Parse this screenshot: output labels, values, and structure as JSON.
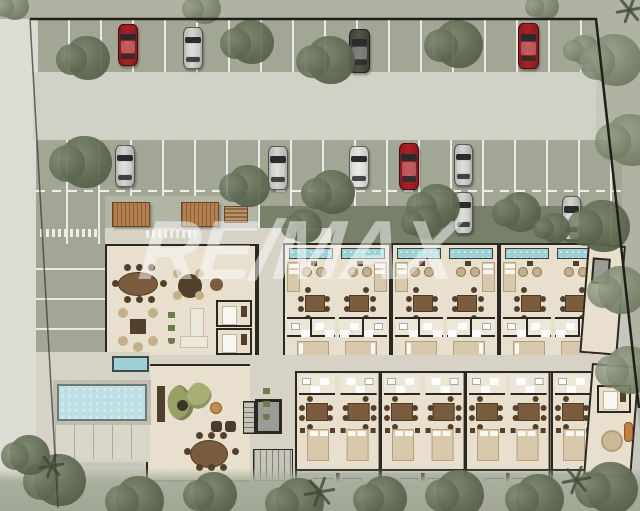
{
  "watermark": {
    "text": "RE/MAX",
    "opacity": 0.5
  },
  "colors": {
    "bg": "#cac9bf",
    "street": "#e0dfd7",
    "outside": "#b2b4a4",
    "cobble": "#a4a896",
    "driveway": "#d3d4c9",
    "hedge": "#79816b",
    "deck": "#d8d5c9",
    "floor": "#ebe2d0",
    "wall": "#2b2620",
    "pool": "#bfe2e6",
    "unit_pool": "#9fd2d9",
    "bath": "#f0eadd",
    "wood": "#7b5c3d",
    "wood_dark": "#52402c",
    "rattan": "#c7b18d",
    "pergola": "#b5824f",
    "sofa_green": "#99a266",
    "elevator": "#9c9d98",
    "stair": "#c9c7bb",
    "veg": "#5c6750",
    "veg2": "#77816a",
    "car_red": "#ab2025",
    "car_silver": "#d7d8d3",
    "car_white": "#e6e7e3",
    "car_dark": "#54544d",
    "car_win": "#272c2e"
  },
  "cars": [
    {
      "x": 118,
      "y": 24,
      "w": 20,
      "h": 42,
      "color": "red"
    },
    {
      "x": 183,
      "y": 27,
      "w": 20,
      "h": 42,
      "color": "silver"
    },
    {
      "x": 349,
      "y": 29,
      "w": 21,
      "h": 44,
      "color": "dark"
    },
    {
      "x": 518,
      "y": 23,
      "w": 21,
      "h": 46,
      "color": "red"
    },
    {
      "x": 115,
      "y": 145,
      "w": 20,
      "h": 42,
      "color": "silver"
    },
    {
      "x": 268,
      "y": 146,
      "w": 20,
      "h": 44,
      "color": "silver"
    },
    {
      "x": 349,
      "y": 146,
      "w": 20,
      "h": 42,
      "color": "white"
    },
    {
      "x": 399,
      "y": 143,
      "w": 20,
      "h": 47,
      "color": "red"
    },
    {
      "x": 454,
      "y": 144,
      "w": 19,
      "h": 42,
      "color": "silver"
    },
    {
      "x": 454,
      "y": 192,
      "w": 19,
      "h": 42,
      "color": "silver"
    },
    {
      "x": 562,
      "y": 196,
      "w": 19,
      "h": 44,
      "color": "silver"
    }
  ],
  "trees": [
    {
      "x": 88,
      "y": 58,
      "r": 22,
      "tone": "d"
    },
    {
      "x": 252,
      "y": 42,
      "r": 22,
      "tone": "d"
    },
    {
      "x": 331,
      "y": 60,
      "r": 24,
      "tone": "d"
    },
    {
      "x": 459,
      "y": 44,
      "r": 24,
      "tone": "d"
    },
    {
      "x": 585,
      "y": 50,
      "r": 15,
      "tone": "m"
    },
    {
      "x": 205,
      "y": 8,
      "r": 16,
      "tone": "m"
    },
    {
      "x": 545,
      "y": 6,
      "r": 14,
      "tone": "m"
    },
    {
      "x": 15,
      "y": 6,
      "r": 14,
      "tone": "m"
    },
    {
      "x": 86,
      "y": 162,
      "r": 26,
      "tone": "d"
    },
    {
      "x": 249,
      "y": 186,
      "r": 21,
      "tone": "d"
    },
    {
      "x": 333,
      "y": 192,
      "r": 22,
      "tone": "d"
    },
    {
      "x": 438,
      "y": 206,
      "r": 22,
      "tone": "d"
    },
    {
      "x": 521,
      "y": 212,
      "r": 20,
      "tone": "d"
    },
    {
      "x": 604,
      "y": 226,
      "r": 26,
      "tone": "d"
    },
    {
      "x": 305,
      "y": 226,
      "r": 17,
      "tone": "d"
    },
    {
      "x": 425,
      "y": 222,
      "r": 17,
      "tone": "d"
    },
    {
      "x": 555,
      "y": 228,
      "r": 15,
      "tone": "d"
    },
    {
      "x": 616,
      "y": 60,
      "r": 26,
      "tone": "m"
    },
    {
      "x": 632,
      "y": 140,
      "r": 26,
      "tone": "m"
    },
    {
      "x": 622,
      "y": 290,
      "r": 24,
      "tone": "m"
    },
    {
      "x": 630,
      "y": 370,
      "r": 24,
      "tone": "m"
    },
    {
      "x": 60,
      "y": 480,
      "r": 26,
      "tone": "d"
    },
    {
      "x": 140,
      "y": 500,
      "r": 24,
      "tone": "d"
    },
    {
      "x": 215,
      "y": 494,
      "r": 22,
      "tone": "d"
    },
    {
      "x": 300,
      "y": 502,
      "r": 24,
      "tone": "d"
    },
    {
      "x": 385,
      "y": 498,
      "r": 22,
      "tone": "d"
    },
    {
      "x": 460,
      "y": 494,
      "r": 24,
      "tone": "d"
    },
    {
      "x": 540,
      "y": 498,
      "r": 24,
      "tone": "d"
    },
    {
      "x": 612,
      "y": 488,
      "r": 26,
      "tone": "d"
    },
    {
      "x": 30,
      "y": 455,
      "r": 20,
      "tone": "d"
    }
  ],
  "palms": [
    {
      "x": 318,
      "y": 492,
      "s": 16
    },
    {
      "x": 575,
      "y": 480,
      "s": 15
    },
    {
      "x": 50,
      "y": 466,
      "s": 13
    },
    {
      "x": 628,
      "y": 10,
      "s": 14
    }
  ],
  "units": {
    "top_row": {
      "count": 6,
      "x": 283,
      "y": 243,
      "w": 54,
      "h": 114
    },
    "bottom_row": {
      "count": 7,
      "x": 293,
      "y": 371,
      "w": 42.6,
      "h": 100
    },
    "top_features": [
      "plunge-pool",
      "terrace-chairs",
      "bed",
      "dining-table",
      "bathroom",
      "second-bed"
    ],
    "bottom_features": [
      "bathroom",
      "dining-table",
      "bed",
      "terrace-plunge-pool"
    ]
  },
  "furniture": [
    {
      "t": "pergola",
      "n": "pergola-deck",
      "x": 112,
      "y": 202,
      "w": 38,
      "h": 25
    },
    {
      "t": "pergola",
      "n": "pergola-deck",
      "x": 181,
      "y": 202,
      "w": 38,
      "h": 25
    },
    {
      "t": "bike-rack",
      "n": "bike-rack",
      "x": 224,
      "y": 206,
      "w": 24,
      "h": 17
    },
    {
      "t": "grate",
      "n": "drain-grate",
      "x": 40,
      "y": 229,
      "w": 60,
      "h": 8
    },
    {
      "t": "grate",
      "n": "drain-grate",
      "x": 146,
      "y": 230,
      "w": 50,
      "h": 8
    },
    {
      "t": "oval-table",
      "n": "lobby-dining-table",
      "x": 118,
      "y": 272,
      "w": 40,
      "h": 24
    },
    {
      "t": "round-table",
      "n": "lobby-round-table",
      "x": 178,
      "y": 274,
      "w": 24,
      "h": 24
    },
    {
      "t": "side-table",
      "n": "lobby-side-table",
      "x": 210,
      "y": 278,
      "w": 13,
      "h": 13
    },
    {
      "t": "lounge-set",
      "n": "lobby-lounge-set",
      "x": 116,
      "y": 306,
      "w": 44,
      "h": 42
    },
    {
      "t": "desk-sofa",
      "n": "reception-sofa",
      "x": 178,
      "y": 308,
      "w": 28,
      "h": 38
    },
    {
      "t": "plant-row",
      "n": "planter-row",
      "x": 168,
      "y": 306,
      "w": 7,
      "h": 38
    },
    {
      "t": "room-bed",
      "n": "treatment-room",
      "x": 216,
      "y": 300,
      "w": 36,
      "h": 27
    },
    {
      "t": "room-bed",
      "n": "treatment-room",
      "x": 216,
      "y": 328,
      "w": 36,
      "h": 27
    },
    {
      "t": "console",
      "n": "console",
      "x": 157,
      "y": 386,
      "w": 8,
      "h": 36
    },
    {
      "t": "curved-sofa",
      "n": "curved-sofa",
      "x": 167,
      "y": 383,
      "w": 46,
      "h": 40
    },
    {
      "t": "coffee-table",
      "n": "coffee-table",
      "x": 177,
      "y": 400,
      "w": 11,
      "h": 11
    },
    {
      "t": "accent-table",
      "n": "accent-table",
      "x": 210,
      "y": 402,
      "w": 12,
      "h": 12
    },
    {
      "t": "ottoman",
      "n": "ottoman",
      "x": 211,
      "y": 421,
      "w": 11,
      "h": 11
    },
    {
      "t": "ottoman",
      "n": "ottoman",
      "x": 225,
      "y": 421,
      "w": 11,
      "h": 11
    },
    {
      "t": "plant-row",
      "n": "planter-row",
      "x": 263,
      "y": 382,
      "w": 7,
      "h": 38
    },
    {
      "t": "oval-table",
      "n": "lounge-dining-table",
      "x": 190,
      "y": 440,
      "w": 38,
      "h": 28
    },
    {
      "t": "rug",
      "n": "round-rug",
      "x": 601,
      "y": 430,
      "w": 22,
      "h": 22
    },
    {
      "t": "lounger",
      "n": "lounger",
      "x": 624,
      "y": 422,
      "w": 9,
      "h": 20
    },
    {
      "t": "room-bed",
      "n": "end-suite-bed",
      "x": 597,
      "y": 385,
      "w": 34,
      "h": 28
    }
  ],
  "boundary": {
    "outline": "30,19 596,19 639,408",
    "left_edge": {
      "x1": 30,
      "y1": 19,
      "x2": 58,
      "y2": 508
    }
  }
}
